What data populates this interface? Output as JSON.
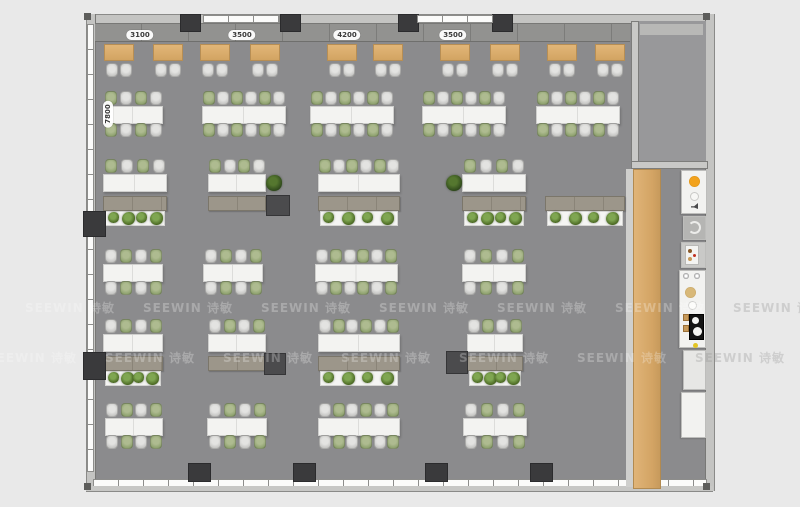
{
  "title": "office floor plan render",
  "watermark": {
    "text": "SEEWIN 诗敏",
    "rows": [
      {
        "y": 299,
        "x0": 25,
        "step": 118,
        "count": 7
      },
      {
        "y": 349,
        "x0": -13,
        "step": 118,
        "count": 7
      }
    ]
  },
  "dimensions": {
    "top_labels": [
      {
        "text": "3100",
        "x": 140
      },
      {
        "text": "3500",
        "x": 242
      },
      {
        "text": "4200",
        "x": 347
      },
      {
        "text": "3500",
        "x": 453
      }
    ],
    "side_label": {
      "text": "7800",
      "x": 108,
      "y": 114
    }
  },
  "colors": {
    "floor": "#8b8b8d",
    "outside": "#e9e9e9",
    "wall": "#c4c4c2",
    "wood": "#d8ab6c",
    "desk_wood": "#d9ab6d",
    "table": "#f3f3f1",
    "chair_gray": "#c9c9c7",
    "chair_green": "#8ea56e",
    "cabinet": "#9c968a",
    "column": "#3a3a3c",
    "accent_orange": "#e8920f",
    "accent_yellow": "#e3c524"
  },
  "layout": {
    "desks": {
      "y": 44,
      "w": 30,
      "h": 17,
      "chair_y": 63,
      "xs": [
        104,
        153,
        200,
        250,
        327,
        373,
        440,
        490,
        547,
        595
      ]
    },
    "table_rows": [
      {
        "chair_top": 91,
        "table": 106,
        "chair_bot": 123,
        "groups": [
          {
            "x": 103,
            "w": 60,
            "seats": 4,
            "first": "green"
          },
          {
            "x": 202,
            "w": 84,
            "seats": 6,
            "first": "green"
          },
          {
            "x": 310,
            "w": 84,
            "seats": 6,
            "first": "green"
          },
          {
            "x": 422,
            "w": 84,
            "seats": 6,
            "first": "green"
          },
          {
            "x": 536,
            "w": 84,
            "seats": 6,
            "first": "green"
          }
        ]
      },
      {
        "chair_top": 159,
        "table": 174,
        "cabinet_y": 196,
        "planter_y": 211,
        "groups": [
          {
            "x": 103,
            "w": 64,
            "seats": 4,
            "first": "green",
            "cabinet": true,
            "planter": true
          },
          {
            "x": 208,
            "w": 58,
            "seats": 4,
            "first": "green",
            "cabinet": true
          },
          {
            "x": 318,
            "w": 82,
            "seats": 6,
            "first": "green",
            "cabinet": true,
            "planter": true
          },
          {
            "x": 462,
            "w": 64,
            "seats": 4,
            "first": "green",
            "cabinet": true,
            "planter": true
          },
          {
            "x": 545,
            "w": 80,
            "seats": 0,
            "cabinet": true,
            "planter": true
          }
        ]
      },
      {
        "chair_top": 249,
        "table": 264,
        "chair_bot": 281,
        "groups": [
          {
            "x": 103,
            "w": 60,
            "seats": 4,
            "first": "gray"
          },
          {
            "x": 203,
            "w": 60,
            "seats": 4,
            "first": "gray"
          },
          {
            "x": 315,
            "w": 83,
            "seats": 6,
            "first": "gray"
          },
          {
            "x": 462,
            "w": 64,
            "seats": 4,
            "first": "gray"
          }
        ]
      },
      {
        "chair_top": 319,
        "table": 334,
        "cabinet_y": 356,
        "planter_y": 371,
        "groups": [
          {
            "x": 103,
            "w": 60,
            "seats": 4,
            "first": "gray",
            "cabinet": true,
            "planter": true
          },
          {
            "x": 208,
            "w": 58,
            "seats": 4,
            "first": "gray",
            "cabinet": true
          },
          {
            "x": 318,
            "w": 82,
            "seats": 6,
            "first": "gray",
            "cabinet": true,
            "planter": true
          },
          {
            "x": 467,
            "w": 56,
            "seats": 4,
            "first": "gray",
            "cabinet": true,
            "planter": true
          }
        ]
      },
      {
        "chair_top": 403,
        "table": 418,
        "chair_bot": 435,
        "groups": [
          {
            "x": 105,
            "w": 58,
            "seats": 4,
            "first": "gray"
          },
          {
            "x": 207,
            "w": 60,
            "seats": 4,
            "first": "gray"
          },
          {
            "x": 318,
            "w": 82,
            "seats": 6,
            "first": "gray"
          },
          {
            "x": 463,
            "w": 64,
            "seats": 4,
            "first": "gray"
          }
        ]
      }
    ],
    "cubes": [
      {
        "x": 266,
        "y": 195,
        "w": 22,
        "h": 19
      },
      {
        "x": 264,
        "y": 353,
        "w": 20,
        "h": 20
      },
      {
        "x": 446,
        "y": 351,
        "w": 20,
        "h": 21
      }
    ],
    "plants_standalone": [
      {
        "x": 266,
        "y": 175,
        "s": 16
      },
      {
        "x": 446,
        "y": 175,
        "s": 16
      }
    ],
    "columns": [
      [
        180,
        14,
        19,
        16
      ],
      [
        280,
        14,
        19,
        16
      ],
      [
        398,
        14,
        19,
        16
      ],
      [
        492,
        14,
        19,
        16
      ],
      [
        188,
        463,
        21,
        17
      ],
      [
        293,
        463,
        21,
        17
      ],
      [
        425,
        463,
        21,
        17
      ],
      [
        530,
        463,
        21,
        17
      ],
      [
        83,
        211,
        21,
        24
      ],
      [
        83,
        352,
        21,
        26
      ]
    ],
    "windows_top": [
      [
        203,
        15,
        75,
        6
      ],
      [
        417,
        15,
        74,
        6
      ]
    ],
    "corners": [
      [
        84,
        13
      ],
      [
        703,
        13
      ],
      [
        84,
        483
      ],
      [
        703,
        483
      ]
    ],
    "pantry": [
      {
        "x": 681,
        "y": 170,
        "w": 26,
        "h": 44,
        "bg": "white",
        "name": "pantry-sink-unit",
        "icons": [
          "orange-dot",
          "ring",
          "speaker"
        ]
      },
      {
        "x": 683,
        "y": 216,
        "w": 23,
        "h": 24,
        "bg": "gray",
        "name": "pantry-basin-unit",
        "icons": [
          "c-shape"
        ]
      },
      {
        "x": 681,
        "y": 242,
        "w": 25,
        "h": 26,
        "bg": "gray2",
        "name": "coffee-machine",
        "icons": [
          "mini-machine"
        ]
      },
      {
        "x": 679,
        "y": 270,
        "w": 27,
        "h": 78,
        "bg": "white",
        "name": "pantry-cooktop-counter",
        "icons": [
          "fans",
          "tan-dot",
          "white-dot",
          "cups",
          "cooktop",
          "yellow-dot"
        ]
      },
      {
        "x": 683,
        "y": 350,
        "w": 23,
        "h": 40,
        "bg": "light",
        "name": "pantry-counter"
      },
      {
        "x": 681,
        "y": 392,
        "w": 25,
        "h": 46,
        "bg": "white",
        "name": "pantry-counter"
      }
    ]
  }
}
